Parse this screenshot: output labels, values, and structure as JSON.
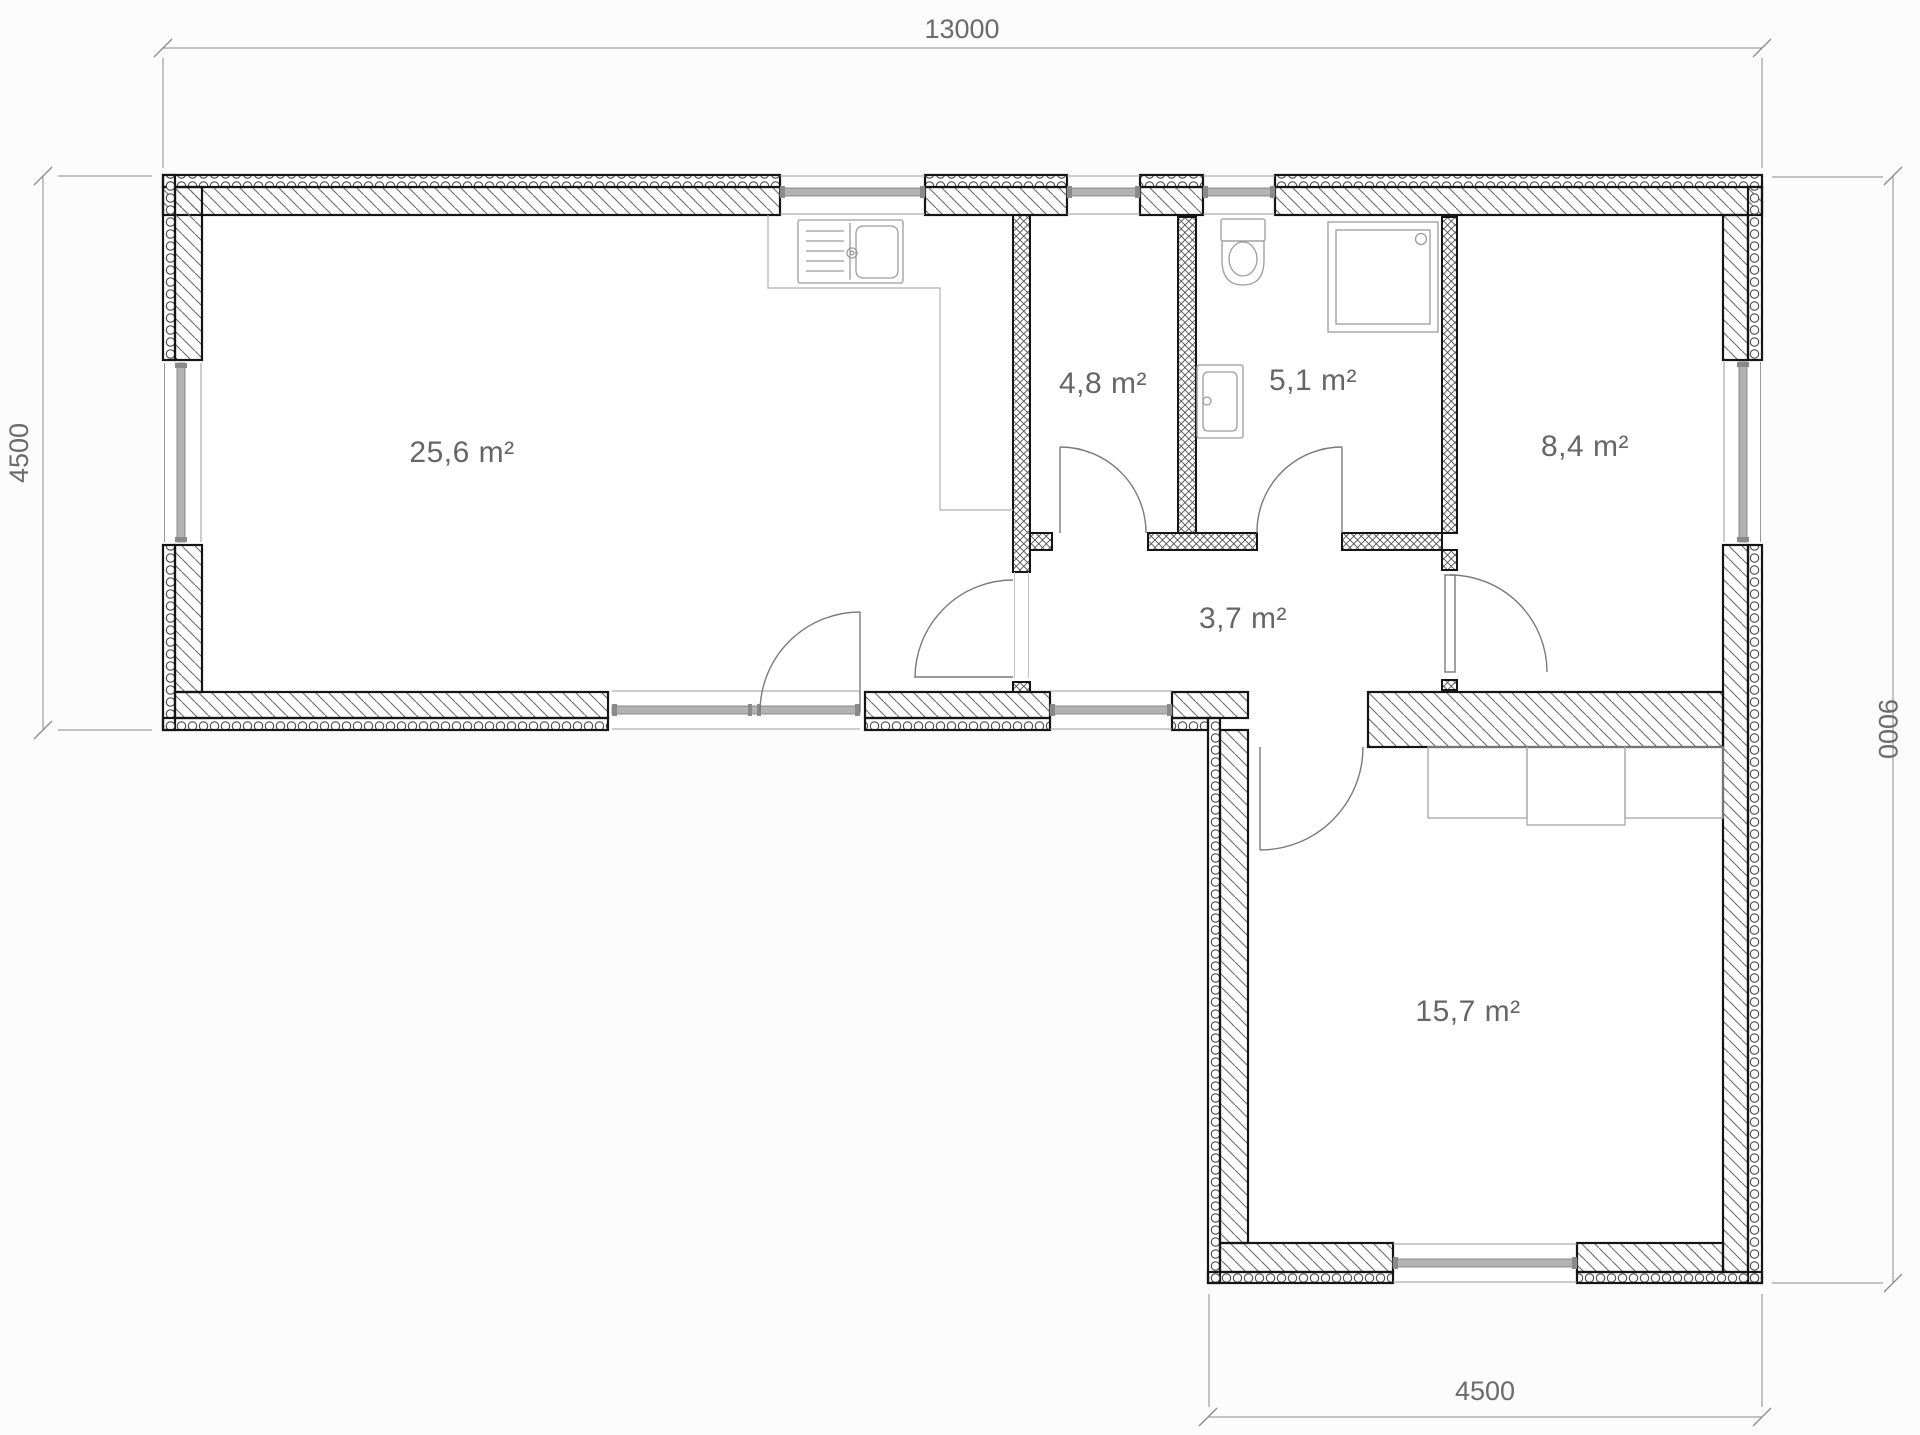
{
  "plan": {
    "type": "architectural-floor-plan",
    "rooms": [
      {
        "id": "living-kitchen",
        "label": "25,6 m²"
      },
      {
        "id": "room-4-8",
        "label": "4,8 m²"
      },
      {
        "id": "room-5-1",
        "label": "5,1 m²"
      },
      {
        "id": "room-8-4",
        "label": "8,4 m²"
      },
      {
        "id": "hall",
        "label": "3,7 m²"
      },
      {
        "id": "room-15-7",
        "label": "15,7 m²"
      }
    ],
    "dimensions": {
      "top": "13000",
      "left": "4500",
      "right": "9000",
      "bottom": "4500"
    },
    "fixtures": [
      "kitchen-sink",
      "kitchen-counter",
      "toilet",
      "shower",
      "washing-machine",
      "wardrobe"
    ],
    "colors": {
      "wall_line": "#151515",
      "hatch_line": "#666666",
      "dim_line": "#8a8a8a",
      "text": "#666666",
      "glazing": "#b3b3b3",
      "background": "#fcfcfc"
    }
  }
}
